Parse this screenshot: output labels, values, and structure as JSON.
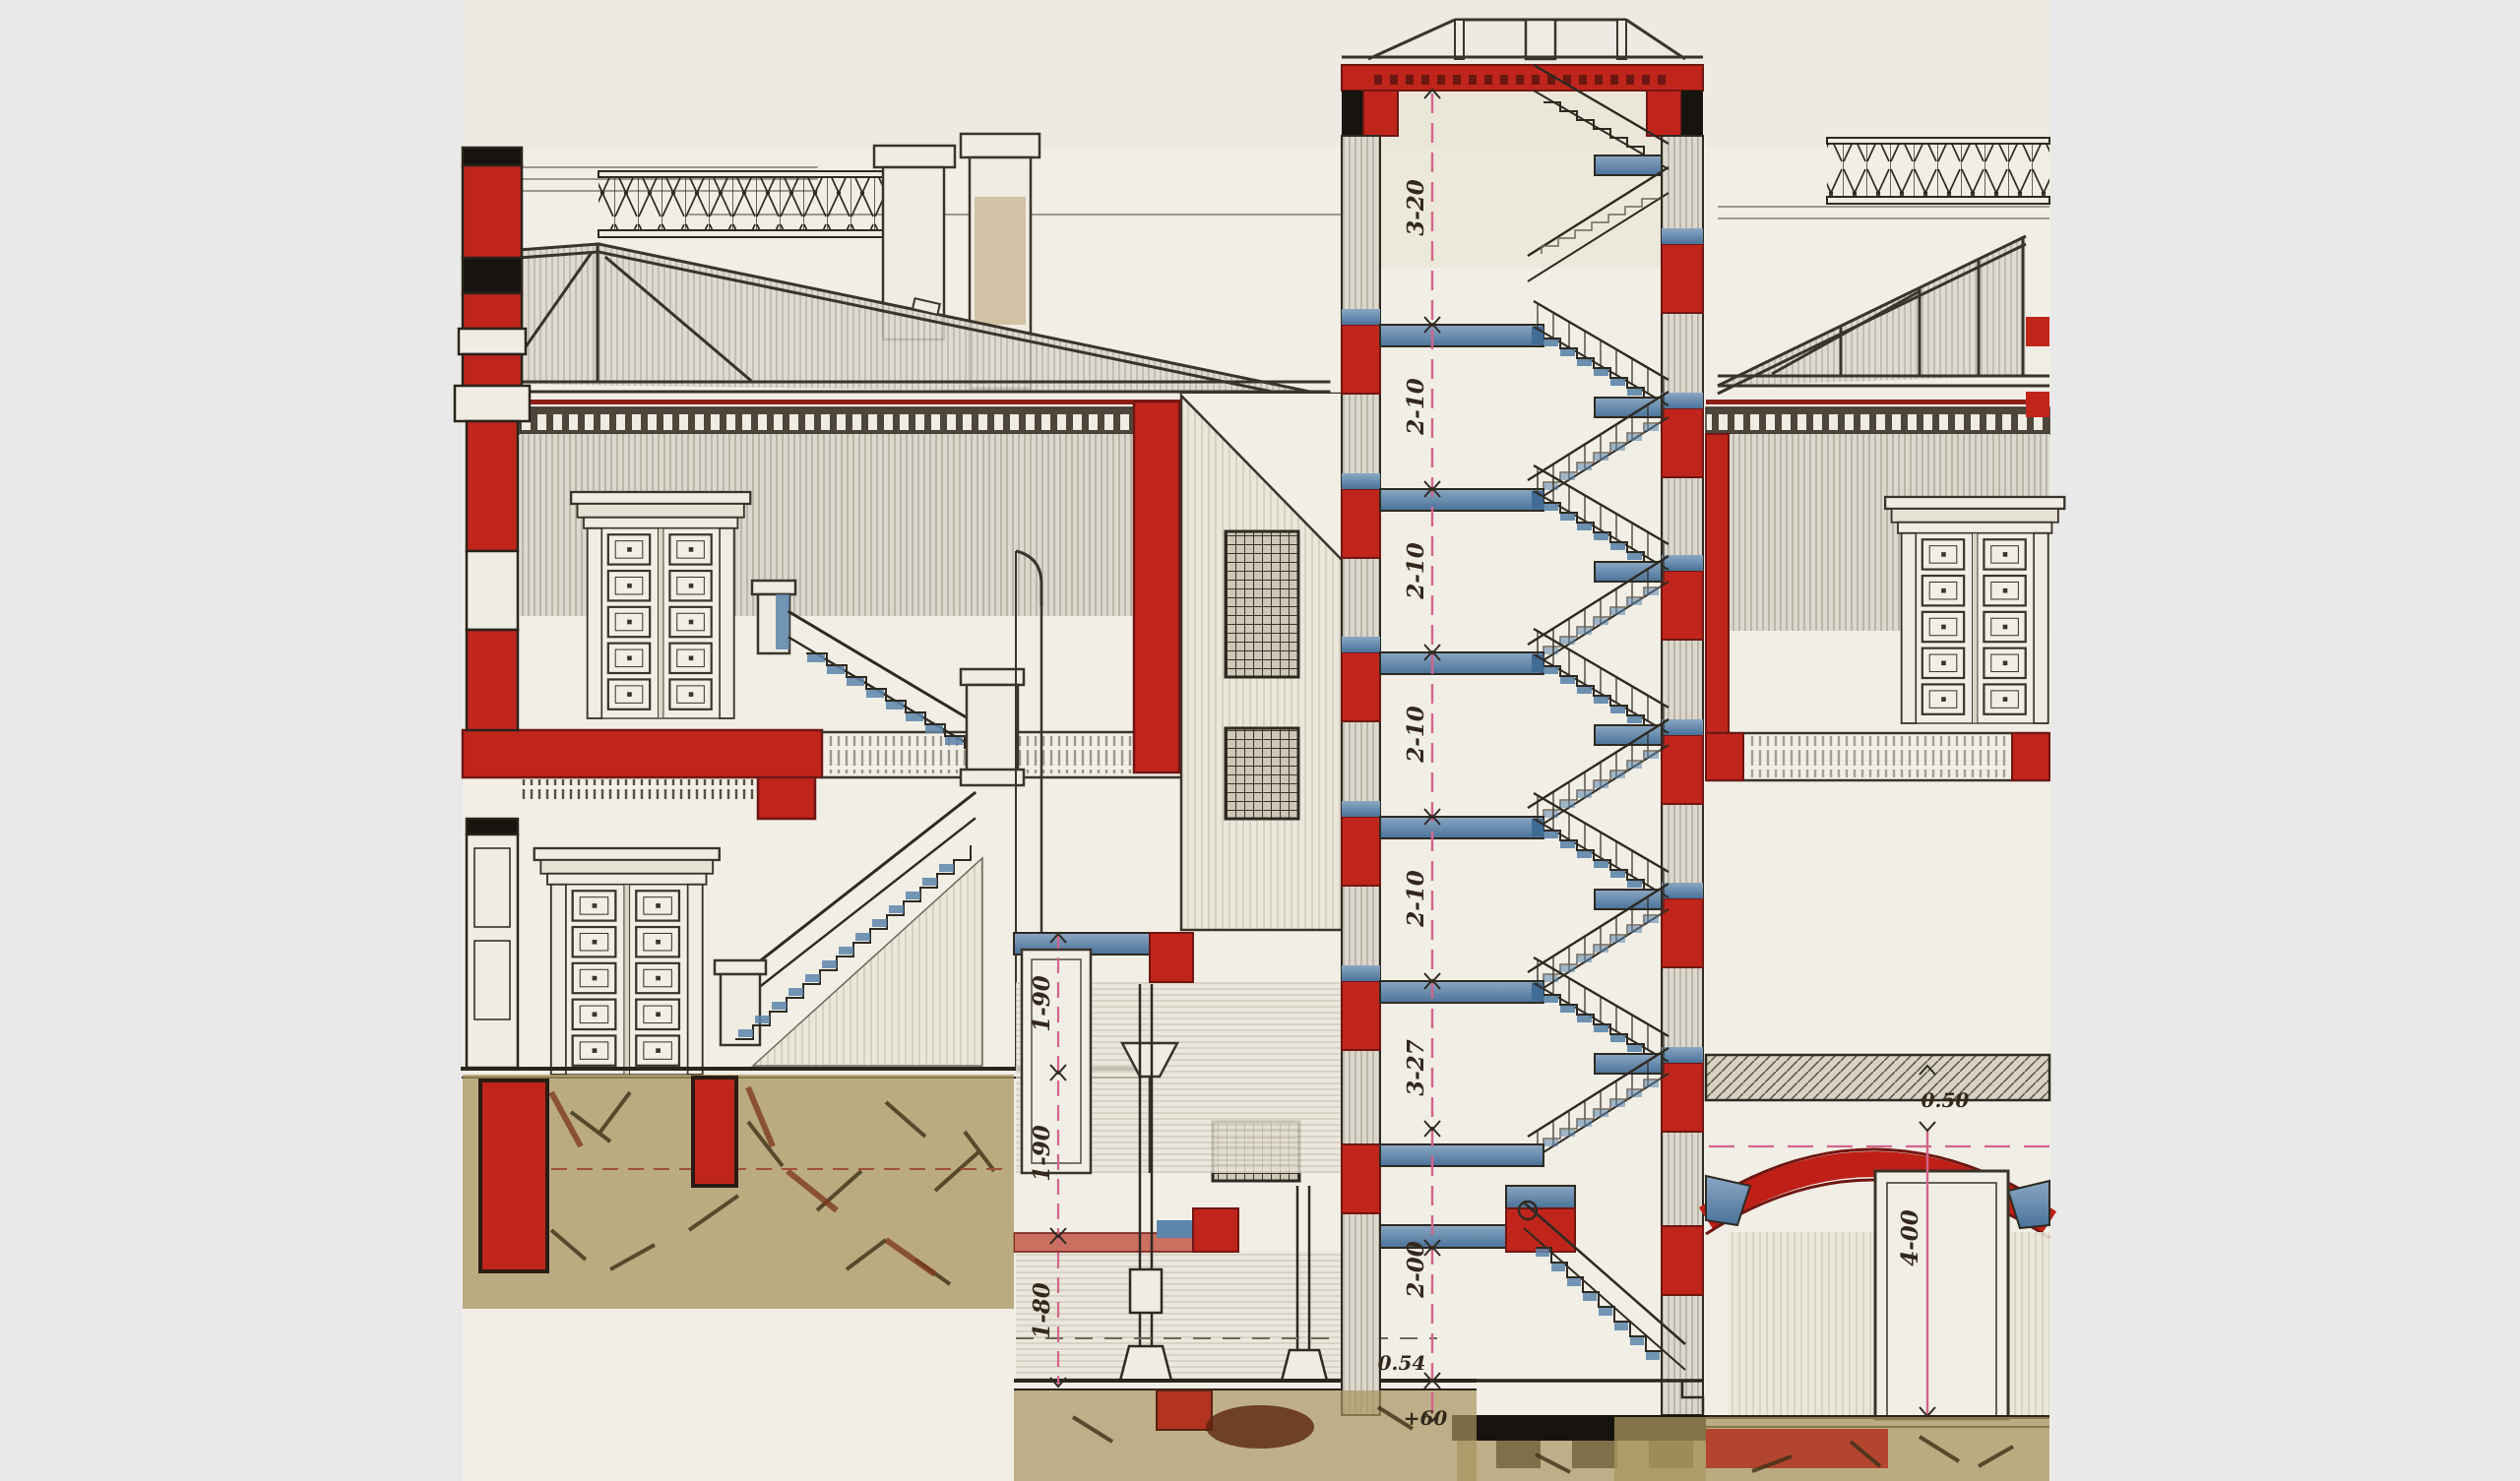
{
  "document": {
    "kind": "scanned architectural drawing",
    "subject": "building cross-section with central staircase shaft, vaulted cellar and roof trusses"
  },
  "palette": {
    "margin_gray": "#e9e9e9",
    "paper": "#f1eee6",
    "ink": "#3a342a",
    "section_red": "#c0251c",
    "slab_pink": "#cb6f60",
    "steel_blue": "#5d86ab",
    "dim_pink": "#d4648c",
    "earth_olive": "#a8945f",
    "earth_brown": "#4f3d20"
  },
  "dimensions": {
    "stair_shaft": [
      "3-20",
      "2-10",
      "2-10",
      "2-10",
      "2-10",
      "3-27",
      "2-00",
      "0.54",
      "+60"
    ],
    "left_rooms": [
      "1-90",
      "1-90",
      "1-80"
    ],
    "vault": {
      "crown_thickness": "0.50",
      "hall_height": "4-00"
    }
  }
}
